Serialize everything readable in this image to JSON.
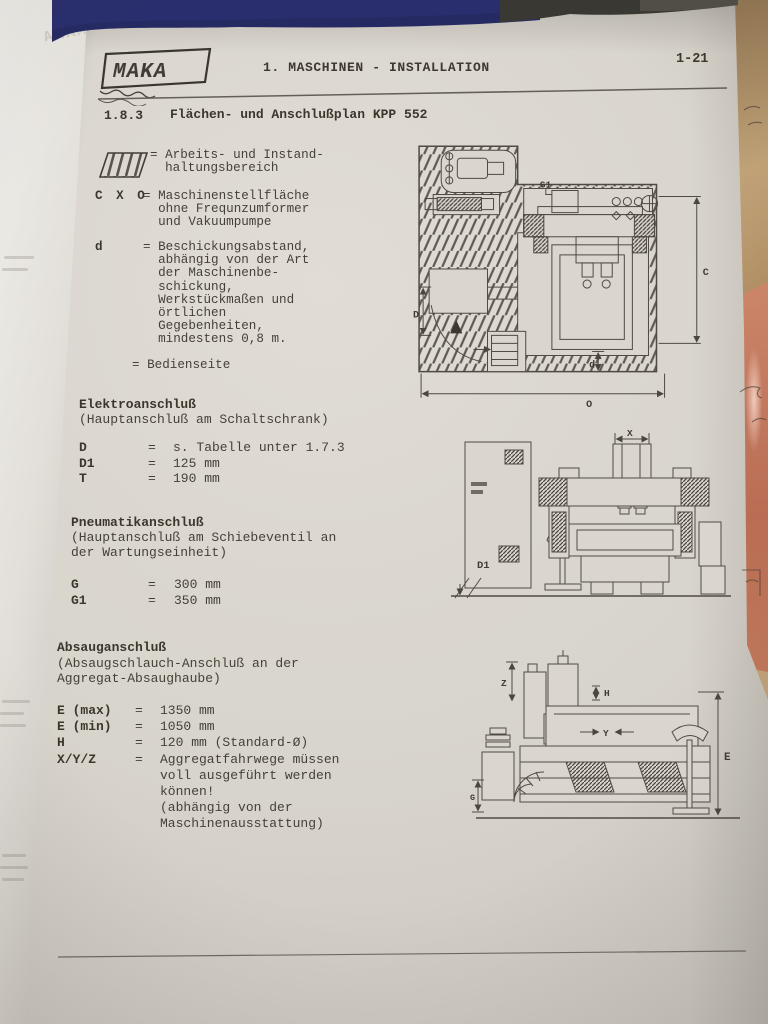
{
  "photo": {
    "colors": {
      "paper": "#dcd9d3",
      "ink": "#3f3a33",
      "navy_band": "#1d2361",
      "cardboard": "#b08c63",
      "salmon_folder": "#c3735a"
    }
  },
  "header": {
    "logo_text": "MAKA",
    "title": "1. MASCHINEN - INSTALLATION",
    "page_number": "1-21"
  },
  "section": {
    "number": "1.8.3",
    "title": "Flächen- und Anschlußplan KPP 552"
  },
  "symbols": {
    "equals": "="
  },
  "legend": {
    "work_area": {
      "text": "= Arbeits- und Instand-\n  haltungsbereich"
    },
    "cxo": {
      "label": "C X O",
      "text": "= Maschinenstellfläche\n  ohne Frequnzumformer\n  und Vakuumpumpe"
    },
    "distance_d": {
      "label": "d",
      "text": "= Beschickungsabstand,\n  abhängig von der Art\n  der Maschinenbe-\n  schickung,\n  Werkstückmaßen und\n  örtlichen\n  Gegebenheiten,\n  mindestens 0,8 m."
    },
    "operator_side": {
      "text": "= Bedienseite"
    }
  },
  "electrical": {
    "title": "Elektroanschluß",
    "subtitle": "(Hauptanschluß am Schaltschrank)",
    "rows": [
      {
        "key": "D",
        "value": "s. Tabelle unter 1.7.3"
      },
      {
        "key": "D1",
        "value": "125 mm"
      },
      {
        "key": "T",
        "value": "190 mm"
      }
    ]
  },
  "pneumatic": {
    "title": "Pneumatikanschluß",
    "subtitle": "(Hauptanschluß am Schiebeventil an\nder Wartungseinheit)",
    "rows": [
      {
        "key": "G",
        "value": "300 mm"
      },
      {
        "key": "G1",
        "value": "350 mm"
      }
    ]
  },
  "extraction": {
    "title": "Absauganschluß",
    "subtitle": "(Absaugschlauch-Anschluß an der\nAggregat-Absaughaube)",
    "rows": [
      {
        "key": "E (max)",
        "value": "1350 mm"
      },
      {
        "key": "E (min)",
        "value": "1050 mm"
      },
      {
        "key": "H",
        "value": "120 mm (Standard-Ø)"
      },
      {
        "key": "X/Y/Z",
        "value": "Aggregatfahrwege müssen\nvoll ausgeführt werden\nkönnen!\n(abhängig von der\nMaschinenausstattung)"
      }
    ]
  },
  "drawings": {
    "plan_view": {
      "labels": {
        "g1": "G1",
        "c": "C",
        "big_d": "D",
        "small_d": "d",
        "o": "O"
      }
    },
    "front_view": {
      "labels": {
        "x": "X",
        "d1": "D1"
      }
    },
    "side_view": {
      "labels": {
        "z": "Z",
        "h": "H",
        "y": "Y",
        "e": "E",
        "g": "G"
      }
    }
  },
  "underlay": {
    "showthrough_text": "MAKA"
  }
}
